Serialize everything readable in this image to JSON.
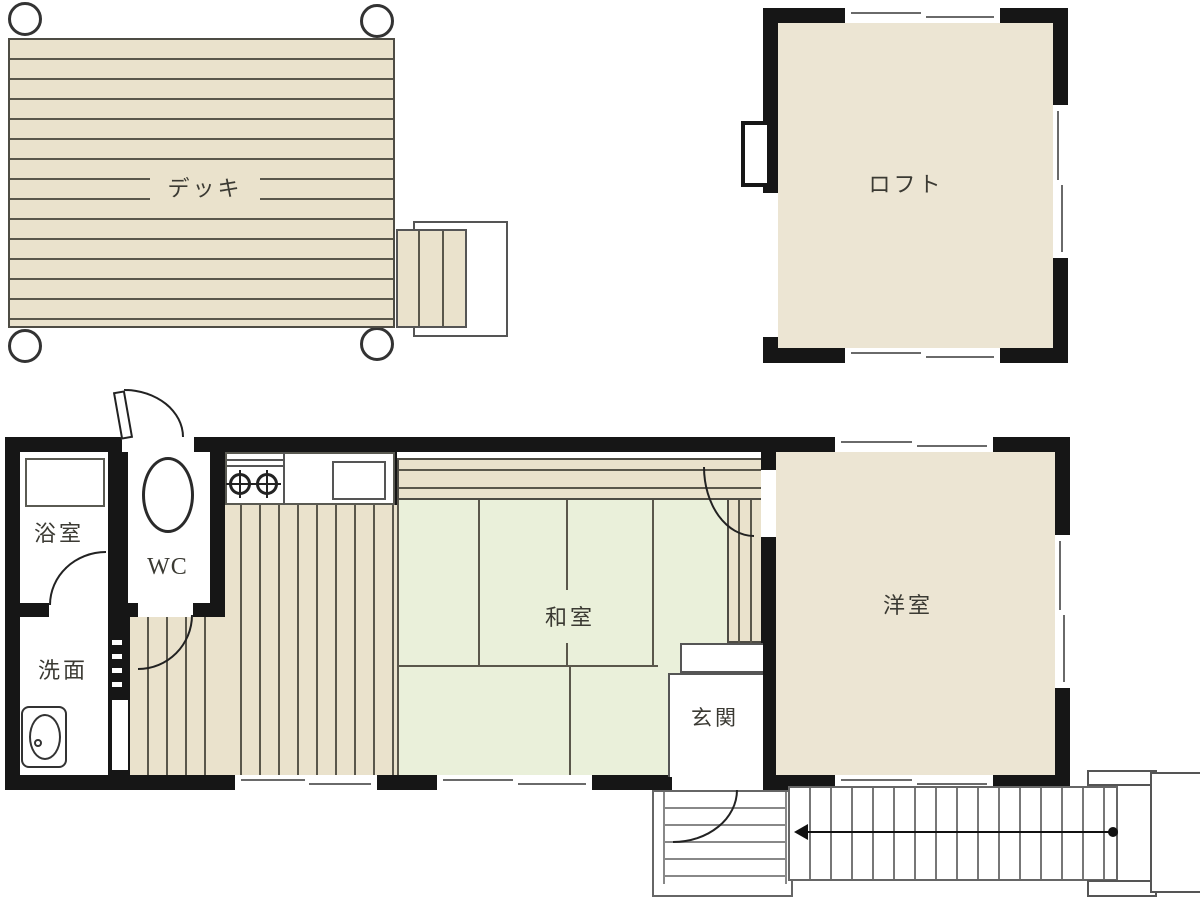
{
  "plan": {
    "rooms": {
      "deck": "デッキ",
      "loft": "ロフト",
      "bathroom": "浴室",
      "toilet": "WC",
      "washroom": "洗面",
      "tatami_room": "和室",
      "entrance": "玄関",
      "western_room": "洋室"
    },
    "colors": {
      "wall": "#161616",
      "wood": "#eae2cc",
      "wood2": "#ece5d3",
      "tatami": "#eaf0da",
      "line": "#5a574b",
      "bd": "#4e4c44",
      "text": "#3b3a33"
    }
  }
}
